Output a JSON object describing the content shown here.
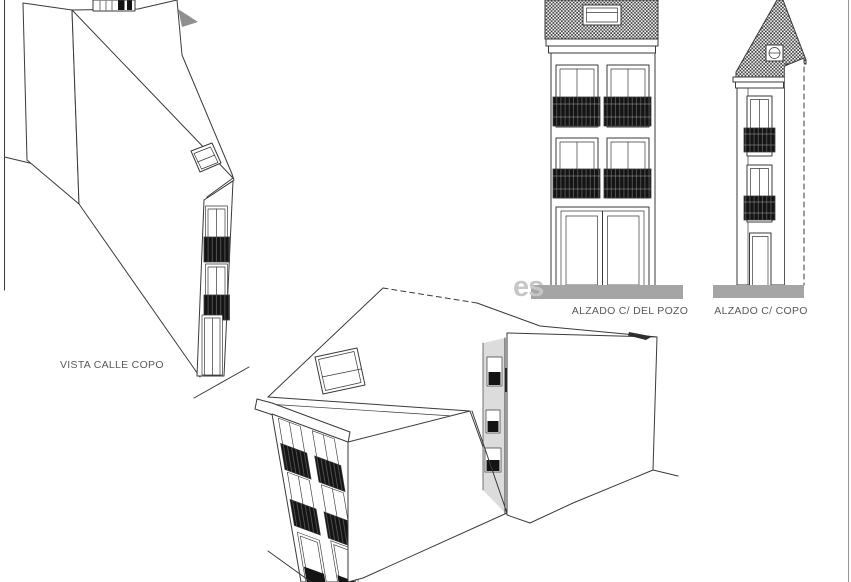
{
  "sheet": {
    "background": "#ffffff"
  },
  "watermark": {
    "text": "es"
  },
  "views": {
    "vista_calle_copo": {
      "label": "VISTA CALLE COPO",
      "type": "3d-perspective-view"
    },
    "alzado_del_pozo": {
      "label": "ALZADO C/ DEL POZO",
      "type": "front-elevation"
    },
    "alzado_copo": {
      "label": "ALZADO C/ COPO",
      "type": "side-elevation"
    },
    "perspective_corner": {
      "type": "3d-perspective-view"
    }
  },
  "colors": {
    "line": "#3a3a3a",
    "ground": "#a5a5a5",
    "shade": "#dcdcdc",
    "balcony": "#141414",
    "label": "#5a5a5a",
    "watermark": "#c6c6c6",
    "border": "#949494"
  }
}
